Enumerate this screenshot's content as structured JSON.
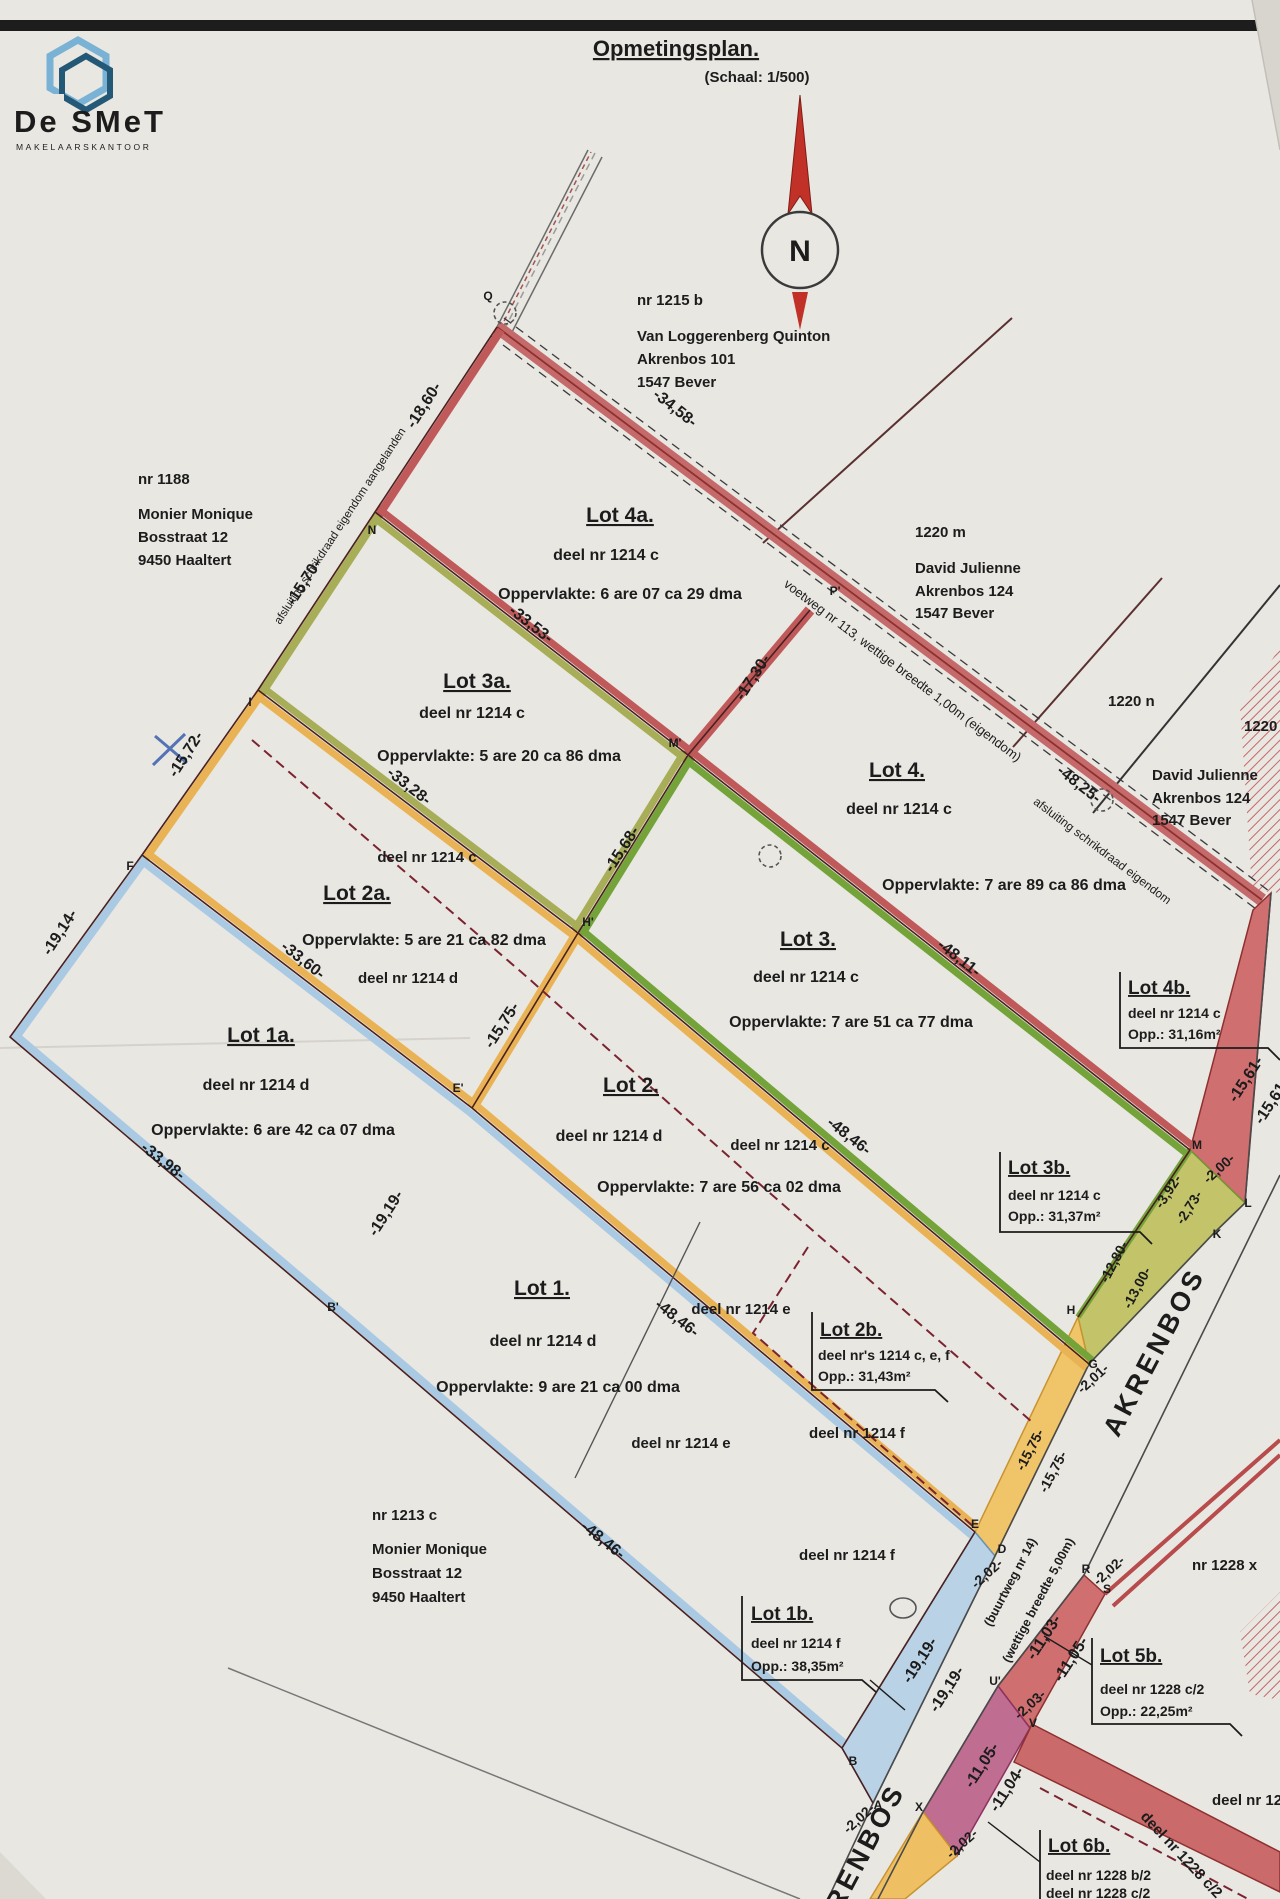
{
  "document": {
    "type": "scanned-survey-plan",
    "title": "Opmetingsplan.",
    "scale_note": "(Schaal: 1/500)"
  },
  "logo": {
    "name": "De SMeT",
    "subtitle": "MAKELAARSKANTOOR",
    "color_light": "#79b2d4",
    "color_dark": "#245877",
    "color_text": "#4e86ac"
  },
  "compass": {
    "label": "N",
    "color": "#c23127"
  },
  "palette": {
    "red": "#c05a5a",
    "dark_red": "#8e3030",
    "olive": "#a8ad58",
    "orange": "#e9b355",
    "green": "#74a339",
    "blue": "#aac9e2",
    "magenta": "#bf6d92",
    "dash_maroon": "#7a2430",
    "ink": "#1c1c1c",
    "paper": "#e9e7e2"
  },
  "plan_texts": {
    "defaults": {
      "size": 15,
      "weight": 700,
      "anchor": "middle",
      "color": "#1c1c1c"
    },
    "groups": [
      {
        "name": "title-block",
        "size": 22,
        "items": [
          {
            "t": "Opmetingsplan.",
            "x": 676,
            "y": 56,
            "u": true
          },
          {
            "t": "(Schaal: 1/500)",
            "x": 757,
            "y": 82,
            "size": 15
          }
        ]
      },
      {
        "name": "lot-captions",
        "size": 16,
        "items": [
          {
            "t": "Lot 4a.",
            "x": 620,
            "y": 522,
            "size": 21,
            "u": true
          },
          {
            "t": "deel nr 1214 c",
            "x": 606,
            "y": 560
          },
          {
            "t": "Oppervlakte: 6 are 07 ca 29 dma",
            "x": 620,
            "y": 599
          },
          {
            "t": "Lot 3a.",
            "x": 477,
            "y": 688,
            "size": 21,
            "u": true
          },
          {
            "t": "deel nr 1214 c",
            "x": 472,
            "y": 718
          },
          {
            "t": "Oppervlakte: 5 are 20 ca 86 dma",
            "x": 499,
            "y": 761
          },
          {
            "t": "Lot 2a.",
            "x": 357,
            "y": 900,
            "size": 21,
            "u": true
          },
          {
            "t": "Oppervlakte: 5 are 21 ca 82 dma",
            "x": 424,
            "y": 945
          },
          {
            "t": "Lot 1a.",
            "x": 261,
            "y": 1042,
            "size": 21,
            "u": true
          },
          {
            "t": "deel nr 1214 d",
            "x": 256,
            "y": 1090
          },
          {
            "t": "Oppervlakte: 6 are 42 ca 07 dma",
            "x": 273,
            "y": 1135
          },
          {
            "t": "Lot 4.",
            "x": 897,
            "y": 777,
            "size": 21,
            "u": true
          },
          {
            "t": "deel nr 1214 c",
            "x": 899,
            "y": 814
          },
          {
            "t": "Oppervlakte: 7 are 89 ca 86 dma",
            "x": 1004,
            "y": 890
          },
          {
            "t": "Lot 3.",
            "x": 808,
            "y": 946,
            "size": 21,
            "u": true
          },
          {
            "t": "deel nr 1214 c",
            "x": 806,
            "y": 982
          },
          {
            "t": "Oppervlakte: 7 are 51 ca 77 dma",
            "x": 851,
            "y": 1027
          },
          {
            "t": "Lot 2.",
            "x": 631,
            "y": 1092,
            "size": 21,
            "u": true
          },
          {
            "t": "deel nr 1214 d",
            "x": 609,
            "y": 1141
          },
          {
            "t": "Oppervlakte: 7 are 56 ca 02 dma",
            "x": 719,
            "y": 1192
          },
          {
            "t": "Lot 1.",
            "x": 542,
            "y": 1295,
            "size": 21,
            "u": true
          },
          {
            "t": "deel nr 1214 d",
            "x": 543,
            "y": 1346
          },
          {
            "t": "Oppervlakte: 9 are 21 ca 00 dma",
            "x": 558,
            "y": 1392
          }
        ]
      },
      {
        "name": "boxed-lot-captions",
        "anchor": "start",
        "size": 14,
        "items": [
          {
            "t": "Lot 4b.",
            "x": 1128,
            "y": 994,
            "size": 19,
            "u": true
          },
          {
            "t": "deel nr 1214 c",
            "x": 1128,
            "y": 1018
          },
          {
            "t": "Opp.: 31,16m²",
            "x": 1128,
            "y": 1039
          },
          {
            "t": "Lot 3b.",
            "x": 1008,
            "y": 1174,
            "size": 19,
            "u": true
          },
          {
            "t": "deel nr 1214 c",
            "x": 1008,
            "y": 1200
          },
          {
            "t": "Opp.: 31,37m²",
            "x": 1008,
            "y": 1221
          },
          {
            "t": "Lot 2b.",
            "x": 820,
            "y": 1336,
            "size": 19,
            "u": true
          },
          {
            "t": "deel nr's 1214 c, e, f",
            "x": 818,
            "y": 1360
          },
          {
            "t": "Opp.: 31,43m²",
            "x": 818,
            "y": 1381
          },
          {
            "t": "Lot 1b.",
            "x": 751,
            "y": 1620,
            "size": 19,
            "u": true
          },
          {
            "t": "deel nr 1214 f",
            "x": 751,
            "y": 1648
          },
          {
            "t": "Opp.: 38,35m²",
            "x": 751,
            "y": 1671
          },
          {
            "t": "Lot 5b.",
            "x": 1100,
            "y": 1662,
            "size": 19,
            "u": true
          },
          {
            "t": "deel nr 1228 c/2",
            "x": 1100,
            "y": 1694
          },
          {
            "t": "Opp.: 22,25m²",
            "x": 1100,
            "y": 1716
          },
          {
            "t": "Lot 6b.",
            "x": 1048,
            "y": 1852,
            "size": 19,
            "u": true
          },
          {
            "t": "deel nr 1228 b/2",
            "x": 1046,
            "y": 1880
          },
          {
            "t": "deel nr 1228 c/2",
            "x": 1046,
            "y": 1898
          }
        ]
      },
      {
        "name": "owner-blocks",
        "anchor": "start",
        "items": [
          {
            "t": "nr 1215 b",
            "x": 637,
            "y": 305
          },
          {
            "t": "Van Loggerenberg Quinton",
            "x": 637,
            "y": 341
          },
          {
            "t": "Akrenbos 101",
            "x": 637,
            "y": 364
          },
          {
            "t": "1547 Bever",
            "x": 637,
            "y": 387
          },
          {
            "t": "nr 1188",
            "x": 138,
            "y": 484
          },
          {
            "t": "Monier Monique",
            "x": 138,
            "y": 519
          },
          {
            "t": "Bosstraat 12",
            "x": 138,
            "y": 542
          },
          {
            "t": "9450 Haaltert",
            "x": 138,
            "y": 565
          },
          {
            "t": "1220 m",
            "x": 915,
            "y": 537
          },
          {
            "t": "David Julienne",
            "x": 915,
            "y": 573
          },
          {
            "t": "Akrenbos 124",
            "x": 915,
            "y": 596
          },
          {
            "t": "1547 Bever",
            "x": 915,
            "y": 618
          },
          {
            "t": "1220 n",
            "x": 1108,
            "y": 706
          },
          {
            "t": "1220",
            "x": 1244,
            "y": 731
          },
          {
            "t": "David Julienne",
            "x": 1152,
            "y": 780
          },
          {
            "t": "Akrenbos 124",
            "x": 1152,
            "y": 803
          },
          {
            "t": "1547 Bever",
            "x": 1152,
            "y": 825
          },
          {
            "t": "nr 1213 c",
            "x": 372,
            "y": 1520
          },
          {
            "t": "Monier Monique",
            "x": 372,
            "y": 1554
          },
          {
            "t": "Bosstraat 12",
            "x": 372,
            "y": 1578
          },
          {
            "t": "9450 Haaltert",
            "x": 372,
            "y": 1602
          },
          {
            "t": "nr 1228 x",
            "x": 1192,
            "y": 1570
          },
          {
            "t": "deel nr 1228",
            "x": 1212,
            "y": 1805
          }
        ]
      },
      {
        "name": "deel-labels",
        "items": [
          {
            "t": "deel nr 1214 c",
            "x": 427,
            "y": 862
          },
          {
            "t": "deel nr 1214 d",
            "x": 408,
            "y": 983
          },
          {
            "t": "deel nr 1214 c",
            "x": 780,
            "y": 1150
          },
          {
            "t": "deel nr 1214 e",
            "x": 741,
            "y": 1314
          },
          {
            "t": "deel nr 1214 e",
            "x": 681,
            "y": 1448
          },
          {
            "t": "deel nr 1214 f",
            "x": 857,
            "y": 1438
          },
          {
            "t": "deel nr 1214 f",
            "x": 847,
            "y": 1560
          },
          {
            "t": "deel nr 1228 c/2",
            "x": 1178,
            "y": 1858,
            "a": 47
          }
        ]
      },
      {
        "name": "measurements",
        "size": 16,
        "items": [
          {
            "t": "-18,60-",
            "x": 428,
            "y": 408,
            "a": -57
          },
          {
            "t": "-15,70-",
            "x": 308,
            "y": 585,
            "a": -57
          },
          {
            "t": "-15,72-",
            "x": 190,
            "y": 757,
            "a": -57
          },
          {
            "t": "-19,14-",
            "x": 64,
            "y": 935,
            "a": -57
          },
          {
            "t": "-34,58-",
            "x": 672,
            "y": 412,
            "a": 38
          },
          {
            "t": "-33,53-",
            "x": 528,
            "y": 628,
            "a": 38
          },
          {
            "t": "-33,28-",
            "x": 406,
            "y": 790,
            "a": 38
          },
          {
            "t": "-33,60-",
            "x": 300,
            "y": 964,
            "a": 38
          },
          {
            "t": "-33,98-",
            "x": 160,
            "y": 1165,
            "a": 38
          },
          {
            "t": "-17,30-",
            "x": 757,
            "y": 680,
            "a": -57
          },
          {
            "t": "-15,68-",
            "x": 626,
            "y": 852,
            "a": -57
          },
          {
            "t": "-15,75-",
            "x": 506,
            "y": 1028,
            "a": -57
          },
          {
            "t": "-19,19-",
            "x": 390,
            "y": 1216,
            "a": -57
          },
          {
            "t": "-48,25-",
            "x": 1076,
            "y": 788,
            "a": 38
          },
          {
            "t": "-48,11-",
            "x": 956,
            "y": 962,
            "a": 38
          },
          {
            "t": "-48,46-",
            "x": 846,
            "y": 1140,
            "a": 38
          },
          {
            "t": "-48,46-",
            "x": 674,
            "y": 1322,
            "a": 38
          },
          {
            "t": "-48,46-",
            "x": 600,
            "y": 1544,
            "a": 38
          },
          {
            "t": "-15,61-",
            "x": 1250,
            "y": 1082,
            "a": -57
          },
          {
            "t": "-15,61-",
            "x": 1276,
            "y": 1104,
            "a": -57
          },
          {
            "t": "-2,00-",
            "x": 1222,
            "y": 1172,
            "a": -42,
            "size": 14
          },
          {
            "t": "-3,92-",
            "x": 1172,
            "y": 1194,
            "a": -57,
            "size": 14
          },
          {
            "t": "-2,73-",
            "x": 1193,
            "y": 1210,
            "a": -57,
            "size": 14
          },
          {
            "t": "-12,80-",
            "x": 1118,
            "y": 1264,
            "a": -62,
            "size": 14
          },
          {
            "t": "-13,00-",
            "x": 1141,
            "y": 1290,
            "a": -62,
            "size": 14
          },
          {
            "t": "-2,01-",
            "x": 1096,
            "y": 1382,
            "a": -42,
            "size": 14
          },
          {
            "t": "-15,75-",
            "x": 1034,
            "y": 1452,
            "a": -62,
            "size": 14
          },
          {
            "t": "-15,75-",
            "x": 1057,
            "y": 1474,
            "a": -62,
            "size": 14
          },
          {
            "t": "-2,02-",
            "x": 990,
            "y": 1577,
            "a": -42,
            "size": 14
          },
          {
            "t": "-2,02-",
            "x": 1112,
            "y": 1574,
            "a": -42,
            "size": 14
          },
          {
            "t": "-11,03-",
            "x": 1048,
            "y": 1640,
            "a": -57
          },
          {
            "t": "-11,05-",
            "x": 1075,
            "y": 1662,
            "a": -57
          },
          {
            "t": "-2,03-",
            "x": 1033,
            "y": 1708,
            "a": -42,
            "size": 14
          },
          {
            "t": "-11,05-",
            "x": 986,
            "y": 1768,
            "a": -57
          },
          {
            "t": "-11,04-",
            "x": 1011,
            "y": 1792,
            "a": -57
          },
          {
            "t": "-2,02-",
            "x": 862,
            "y": 1822,
            "a": -42,
            "size": 14
          },
          {
            "t": "-2,02-",
            "x": 965,
            "y": 1847,
            "a": -42,
            "size": 14
          },
          {
            "t": "-19,19-",
            "x": 924,
            "y": 1663,
            "a": -57
          },
          {
            "t": "-19,19-",
            "x": 951,
            "y": 1692,
            "a": -57
          }
        ]
      },
      {
        "name": "vertex-letters",
        "size": 12,
        "items": [
          {
            "t": "Q",
            "x": 488,
            "y": 300
          },
          {
            "t": "N",
            "x": 372,
            "y": 534
          },
          {
            "t": "I",
            "x": 250,
            "y": 706
          },
          {
            "t": "F",
            "x": 130,
            "y": 870
          },
          {
            "t": "E'",
            "x": 458,
            "y": 1092
          },
          {
            "t": "H'",
            "x": 588,
            "y": 926
          },
          {
            "t": "M'",
            "x": 675,
            "y": 747
          },
          {
            "t": "P'",
            "x": 835,
            "y": 595
          },
          {
            "t": "B'",
            "x": 333,
            "y": 1311
          },
          {
            "t": "B",
            "x": 853,
            "y": 1765
          },
          {
            "t": "A",
            "x": 878,
            "y": 1809
          },
          {
            "t": "M",
            "x": 1197,
            "y": 1149
          },
          {
            "t": "L",
            "x": 1248,
            "y": 1207
          },
          {
            "t": "K",
            "x": 1217,
            "y": 1238
          },
          {
            "t": "H",
            "x": 1071,
            "y": 1314
          },
          {
            "t": "G",
            "x": 1093,
            "y": 1368
          },
          {
            "t": "E",
            "x": 975,
            "y": 1528
          },
          {
            "t": "D",
            "x": 1002,
            "y": 1553
          },
          {
            "t": "R",
            "x": 1086,
            "y": 1573
          },
          {
            "t": "S",
            "x": 1107,
            "y": 1593
          },
          {
            "t": "U'",
            "x": 995,
            "y": 1685
          },
          {
            "t": "V",
            "x": 1033,
            "y": 1727
          },
          {
            "t": "X",
            "x": 919,
            "y": 1811
          },
          {
            "t": "Y",
            "x": 959,
            "y": 1855
          }
        ]
      },
      {
        "name": "street-labels",
        "items": [
          {
            "t": "AKRENBOS",
            "x": 1162,
            "y": 1356,
            "a": -62,
            "size": 27,
            "ls": 4,
            "weight": 600
          },
          {
            "t": "AKRENBOS",
            "x": 862,
            "y": 1872,
            "a": -62,
            "size": 27,
            "ls": 4,
            "weight": 600
          },
          {
            "t": "(buurtweg nr 14)",
            "x": 1014,
            "y": 1584,
            "a": -62,
            "size": 12.5
          },
          {
            "t": "(wettige breedte 5,00m)",
            "x": 1042,
            "y": 1602,
            "a": -62,
            "size": 12.5
          },
          {
            "t": "voetweg nr 113, wettige breedte 1,00m (eigendom)",
            "x": 900,
            "y": 674,
            "a": 37,
            "size": 13,
            "weight": 400
          },
          {
            "t": "afsluiting schrikdraad eigendom",
            "x": 1100,
            "y": 854,
            "a": 37,
            "size": 12,
            "weight": 400
          },
          {
            "t": "afsluiting schrikdraad eigendom aangelanden",
            "x": 343,
            "y": 528,
            "a": -57,
            "size": 11.5,
            "weight": 400
          }
        ]
      }
    ]
  }
}
